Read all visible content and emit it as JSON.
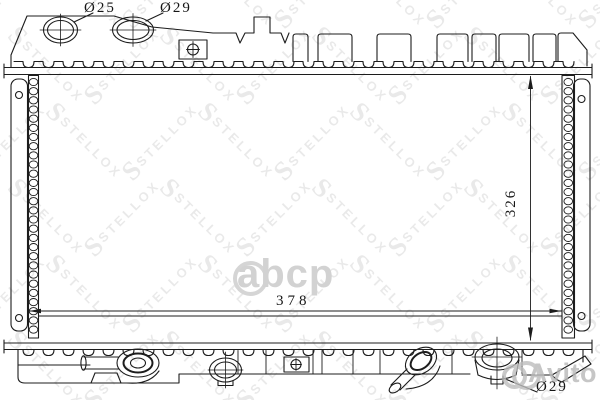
{
  "dimensions": {
    "top_left_diameter": "Ø25",
    "top_right_diameter": "Ø29",
    "core_height": "326",
    "core_width": "378",
    "bottom_port_diameter": "Ø29"
  },
  "watermarks": {
    "brand": "STELLOX",
    "brand_initial": "S",
    "marketplace_abcp": "abcp",
    "marketplace_avito": "Avito"
  }
}
